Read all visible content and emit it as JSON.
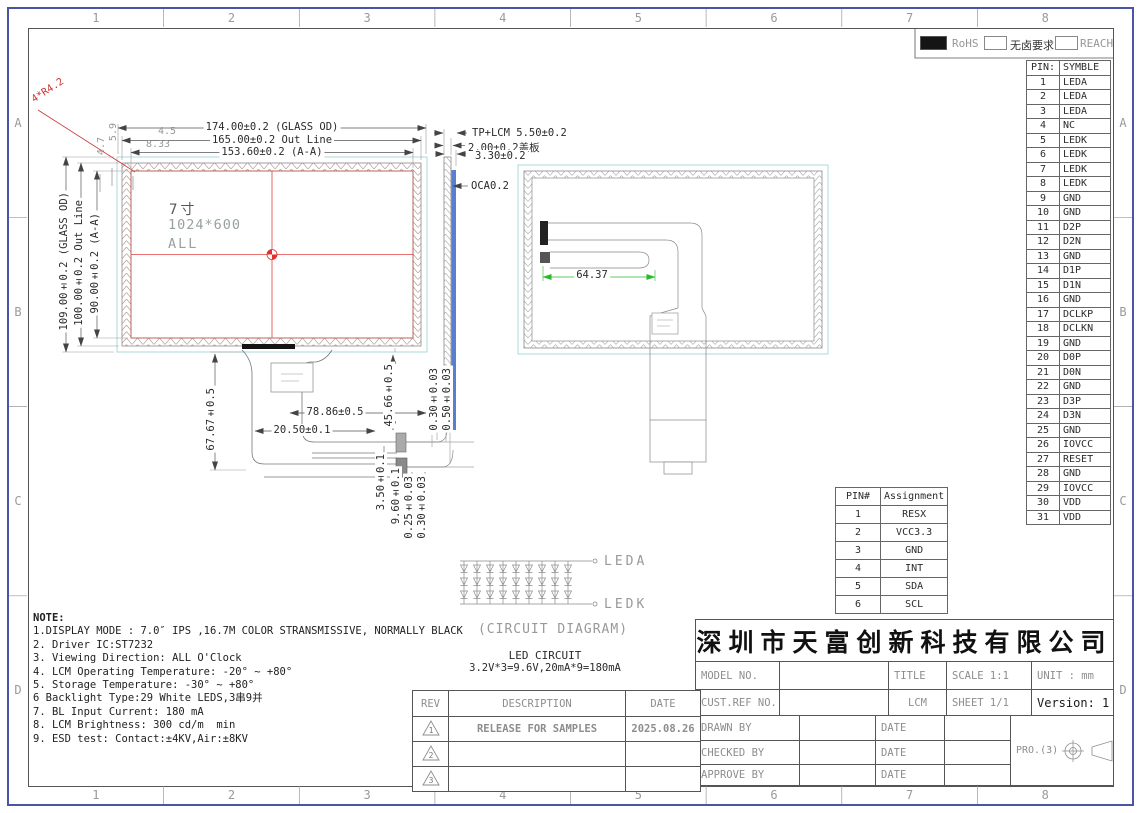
{
  "sheet": {
    "zone_cols": [
      "1",
      "2",
      "3",
      "4",
      "5",
      "6",
      "7",
      "8"
    ],
    "zone_rows": [
      "A",
      "B",
      "C",
      "D"
    ],
    "accent_cyan": "#9fd6d6",
    "accent_red": "#d63b3b",
    "accent_green": "#2db82d",
    "accent_blue": "#5b7fd0"
  },
  "compliance": {
    "rohs": "RoHS",
    "halogen_free": "无卤要求",
    "reach": "REACH"
  },
  "pin_table": {
    "header_pin": "PIN:",
    "header_symbol": "SYMBLE",
    "rows": [
      {
        "pin": "1",
        "symbol": "LEDA"
      },
      {
        "pin": "2",
        "symbol": "LEDA"
      },
      {
        "pin": "3",
        "symbol": "LEDA"
      },
      {
        "pin": "4",
        "symbol": "NC"
      },
      {
        "pin": "5",
        "symbol": "LEDK"
      },
      {
        "pin": "6",
        "symbol": "LEDK"
      },
      {
        "pin": "7",
        "symbol": "LEDK"
      },
      {
        "pin": "8",
        "symbol": "LEDK"
      },
      {
        "pin": "9",
        "symbol": "GND"
      },
      {
        "pin": "10",
        "symbol": "GND"
      },
      {
        "pin": "11",
        "symbol": "D2P"
      },
      {
        "pin": "12",
        "symbol": "D2N"
      },
      {
        "pin": "13",
        "symbol": "GND"
      },
      {
        "pin": "14",
        "symbol": "D1P"
      },
      {
        "pin": "15",
        "symbol": "D1N"
      },
      {
        "pin": "16",
        "symbol": "GND"
      },
      {
        "pin": "17",
        "symbol": "DCLKP"
      },
      {
        "pin": "18",
        "symbol": "DCLKN"
      },
      {
        "pin": "19",
        "symbol": "GND"
      },
      {
        "pin": "20",
        "symbol": "D0P"
      },
      {
        "pin": "21",
        "symbol": "D0N"
      },
      {
        "pin": "22",
        "symbol": "GND"
      },
      {
        "pin": "23",
        "symbol": "D3P"
      },
      {
        "pin": "24",
        "symbol": "D3N"
      },
      {
        "pin": "25",
        "symbol": "GND"
      },
      {
        "pin": "26",
        "symbol": "IOVCC"
      },
      {
        "pin": "27",
        "symbol": "RESET"
      },
      {
        "pin": "28",
        "symbol": "GND"
      },
      {
        "pin": "29",
        "symbol": "IOVCC"
      },
      {
        "pin": "30",
        "symbol": "VDD"
      },
      {
        "pin": "31",
        "symbol": "VDD"
      }
    ]
  },
  "front_view": {
    "size_label": "7寸",
    "resolution": "1024*600",
    "area_label": "ALL",
    "dims_top": [
      "174.00±0.2 (GLASS OD)",
      "165.00±0.2 Out Line",
      "153.60±0.2 (A-A)"
    ],
    "dims_left": [
      "109.00±0.2 (GLASS OD)",
      "100.00±0.2 Out Line",
      "90.00±0.2 (A-A)"
    ],
    "corner_radius": "4*R4.2",
    "corner_dims": [
      "4.5",
      "8.33",
      "5.9",
      "4.7"
    ]
  },
  "side_view": {
    "dim_total": "TP+LCM 5.50±0.2",
    "dim_cover": "2.00±0.2盖板",
    "dim_lcm": "3.30±0.2",
    "dim_oca": "OCA0.2"
  },
  "back_view": {
    "fpc_dim": "64.37"
  },
  "fpc": {
    "dim_height": "67.67±0.5",
    "dim_width": "78.86±0.5",
    "dim_offset": "20.50±0.1",
    "dim_tail": "45.66±0.5",
    "dim_t1": "0.30±0.03",
    "dim_t2": "0.50±0.03",
    "dim_t3": "3.50±0.1",
    "dim_t4": "9.60±0.1",
    "dim_t5": "0.25±0.03",
    "dim_t6": "0.30±0.03"
  },
  "led_circuit": {
    "series": 3,
    "parallel": 9,
    "anode": "LEDA",
    "cathode": "LEDK",
    "caption": "(CIRCUIT DIAGRAM)",
    "title": "LED CIRCUIT",
    "spec": "3.2V*3=9.6V,20mA*9=180mA"
  },
  "notes": {
    "heading": "NOTE:",
    "items": [
      "1.DISPLAY MODE : 7.0″ IPS ,16.7M COLOR STRANSMISSIVE, NORMALLY BLACK",
      "2. Driver IC:ST7232",
      "3. Viewing Direction: ALL O'Clock",
      "4. LCM Operating Temperature: -20° ~ +80°",
      "5. Storage Temperature: -30° ~ +80°",
      "6 Backlight Type:29 White LEDS,3串9并",
      "7. BL Input Current: 180 mA",
      "8. LCM Brightness: 300 cd/m  min",
      "9. ESD test: Contact:±4KV,Air:±8KV"
    ]
  },
  "assignment_table": {
    "headers": [
      "PIN#",
      "Assignment"
    ],
    "rows": [
      {
        "pin": "1",
        "assignment": "RESX"
      },
      {
        "pin": "2",
        "assignment": "VCC3.3"
      },
      {
        "pin": "3",
        "assignment": "GND"
      },
      {
        "pin": "4",
        "assignment": "INT"
      },
      {
        "pin": "5",
        "assignment": "SDA"
      },
      {
        "pin": "6",
        "assignment": "SCL"
      }
    ]
  },
  "title_block": {
    "company": "深圳市天富创新科技有限公司",
    "model_no_label": "MODEL NO.",
    "title_label": "TITLE",
    "scale_label": "SCALE 1:1",
    "unit_label": "UNIT : mm",
    "cust_ref_label": "CUST.REF NO.",
    "product_type": "LCM",
    "sheet_label": "SHEET 1/1",
    "version_label": "Version: 1",
    "rev_label": "REV",
    "description_label": "DESCRIPTION",
    "date_label": "DATE",
    "drawn_label": "DRAWN BY",
    "checked_label": "CHECKED BY",
    "approve_label": "APPROVE BY",
    "projection_label": "PRO.(3)",
    "revisions": [
      {
        "rev": "1",
        "description": "RELEASE FOR SAMPLES",
        "date": "2025.08.26"
      },
      {
        "rev": "2",
        "description": "",
        "date": ""
      },
      {
        "rev": "3",
        "description": "",
        "date": ""
      }
    ]
  }
}
